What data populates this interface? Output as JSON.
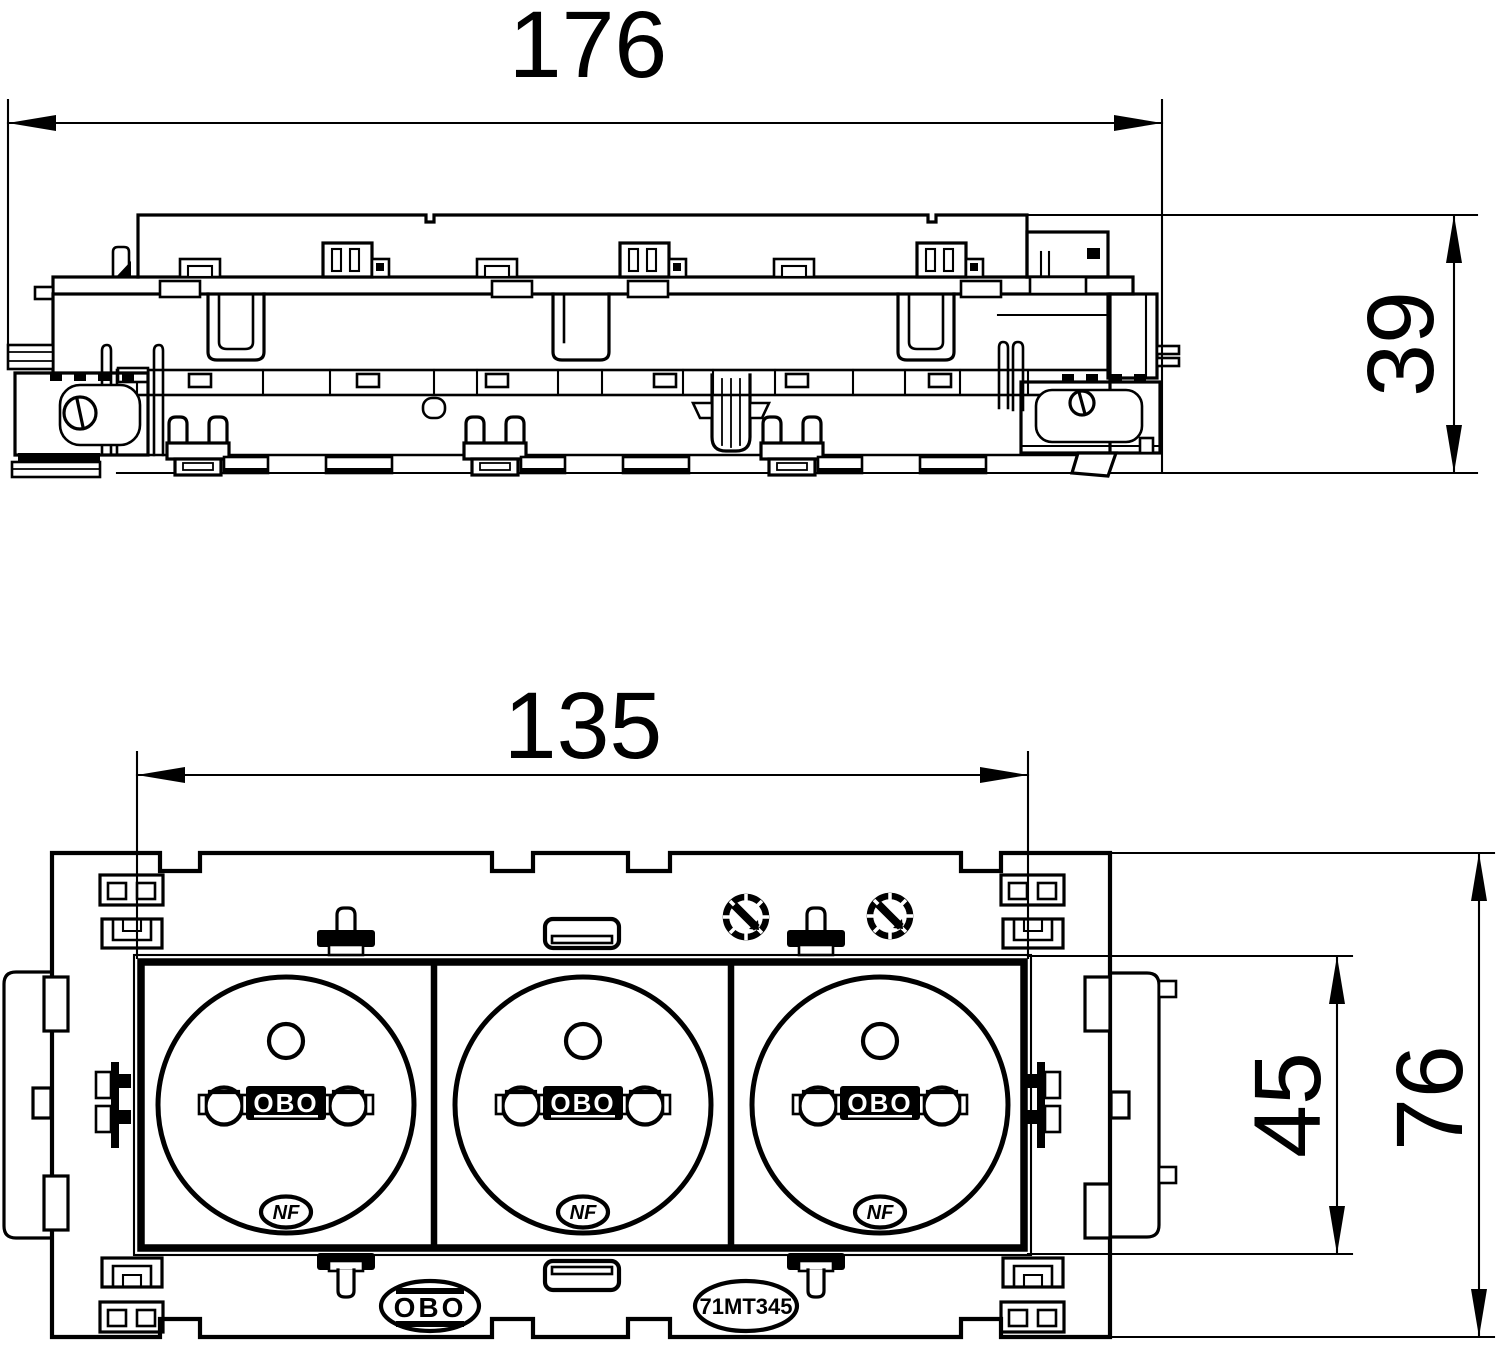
{
  "page": {
    "background": "#ffffff",
    "line_color": "#000000"
  },
  "dimensions": {
    "overall_width": "176",
    "overall_height": "39",
    "module_row_width": "135",
    "insert_height": "45",
    "plate_height": "76"
  },
  "socket": {
    "logo": "OBO",
    "certification": "NF"
  },
  "labels": {
    "brand_logo": "OBO",
    "part_number": "71MT345"
  }
}
